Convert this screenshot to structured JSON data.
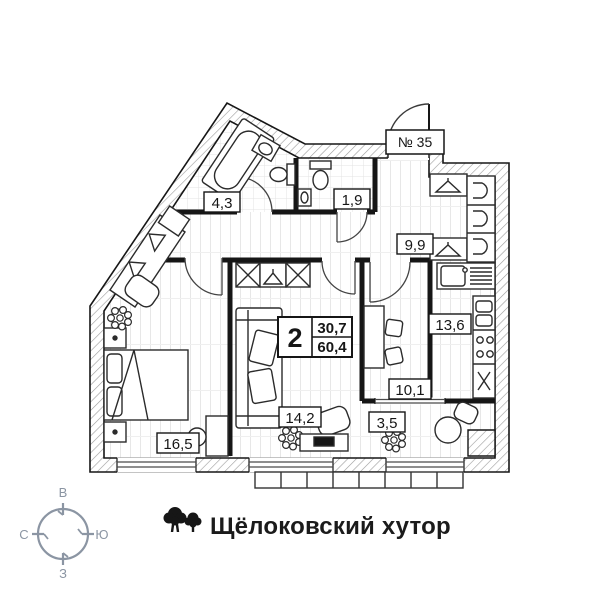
{
  "plan": {
    "unit_number": "№ 35",
    "info_box": {
      "rooms_count": "2",
      "living_area": "30,7",
      "total_area": "60,4"
    },
    "rooms": {
      "bathroom": "4,3",
      "wc": "1,9",
      "hallway": "9,9",
      "kitchen": "13,6",
      "room": "10,1",
      "balcony": "3,5",
      "living": "14,2",
      "bedroom": "16,5"
    }
  },
  "compass": {
    "top": "В",
    "right": "Ю",
    "bottom": "З",
    "left": "С"
  },
  "brand": {
    "name": "Щёлоковский хутор",
    "icon": "trees-icon"
  },
  "colors": {
    "ink": "#161616",
    "wall_hatch": "#9b9b9b",
    "compass": "#8b95a3",
    "background": "#ffffff"
  }
}
